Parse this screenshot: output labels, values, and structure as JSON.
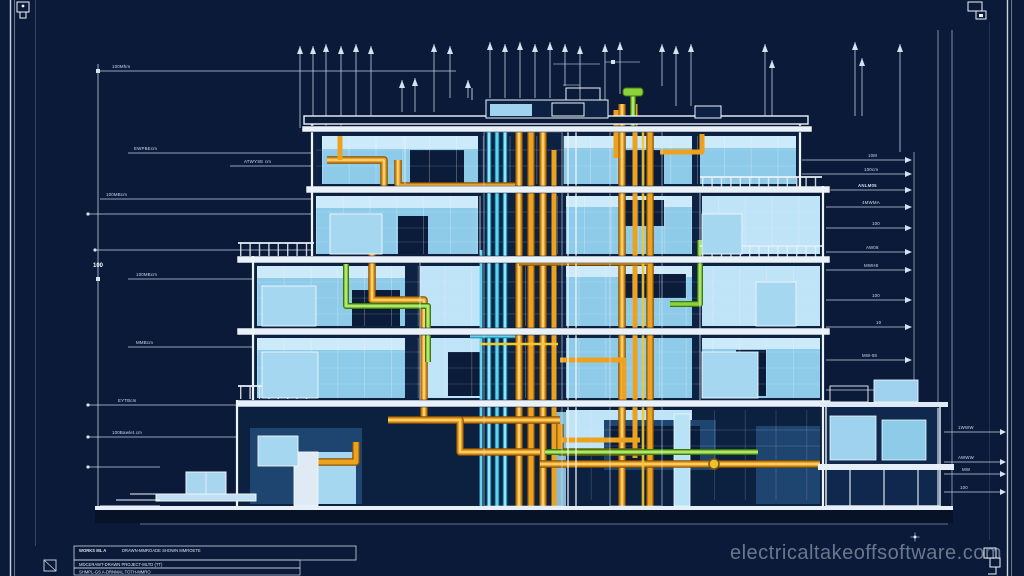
{
  "page": {
    "type": "architectural-blueprint",
    "subject": "building cross-section with electrical and mechanical conduit runs"
  },
  "watermark": {
    "text": "electricaltakeoffsoftware.com"
  },
  "title_block": {
    "line1_bold": "WORKS ML A",
    "line1_rest": "DRAWN-MMROADE SHOWN  MMROETE",
    "line2": "MDCERAWT-DRAWN  PROJECT-MLTD (TT)",
    "line3": "SHMPL-GS A-DRNMAL  TOTH-MMRO"
  },
  "elevation_marks": {
    "left_value": "100"
  },
  "dimension_labels": {
    "left": [
      "100Mhm",
      "EWPBEcm",
      "ATWYSE cm",
      "100MBcm",
      "100MBcm",
      "MMBcm",
      "EYTBcm",
      "100Bawlet.cm"
    ],
    "right": [
      "10M",
      "100cm",
      "ANLM05",
      "4MWMA",
      "100",
      "AW08",
      "MWH8",
      "100",
      "10",
      "MW-08",
      "M8",
      "1WWW",
      "AWWW",
      "MW",
      "100"
    ]
  },
  "colors": {
    "background": "#0b1a38",
    "line_white": "#eef4fb",
    "glass_blue": "#8ecbe9",
    "conduit_orange": "#eda21f",
    "pipe_green": "#8ed13c",
    "pipe_cyan": "#5fd4ee",
    "watermark_gray": "#c1cbdb"
  }
}
